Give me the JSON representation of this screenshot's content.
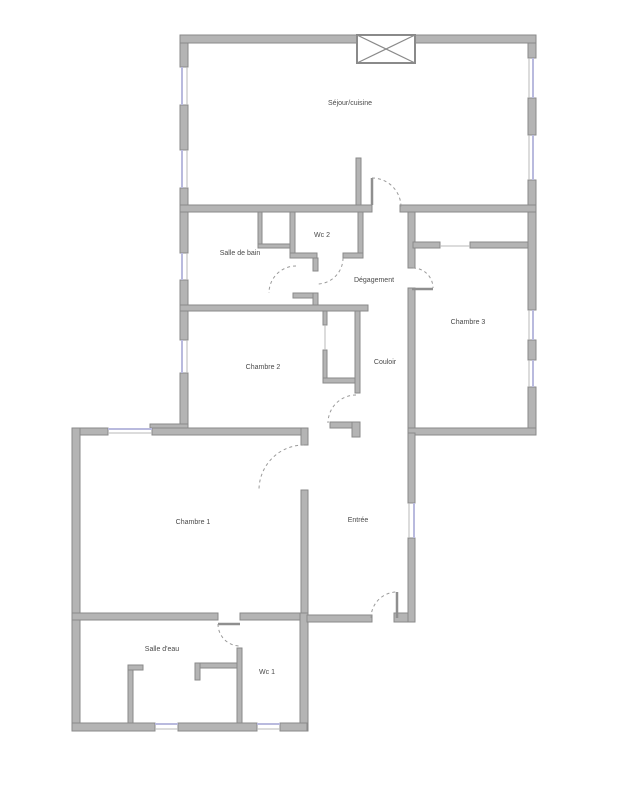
{
  "page": {
    "background": "#ffffff",
    "width": 640,
    "height": 800
  },
  "floorplan": {
    "colors": {
      "wall_fill": "#b4b4b4",
      "wall_stroke": "#8a8a8a",
      "window": "#b9bade",
      "inner_line": "#b9b9b9",
      "thin_wall": "#8f8f8f",
      "door_arc": "#9a9a9a",
      "door_leaf": "#8f8f8f",
      "label": "#4a4a4a"
    },
    "label_font_size": 7,
    "rooms": [
      {
        "id": "sejour-cuisine",
        "label": "Séjour/cuisine",
        "x": 350,
        "y": 105
      },
      {
        "id": "wc-2",
        "label": "Wc 2",
        "x": 322,
        "y": 237
      },
      {
        "id": "salle-de-bain",
        "label": "Salle de bain",
        "x": 240,
        "y": 255
      },
      {
        "id": "degagement",
        "label": "Dégagement",
        "x": 374,
        "y": 282
      },
      {
        "id": "chambre-3",
        "label": "Chambre 3",
        "x": 468,
        "y": 324
      },
      {
        "id": "chambre-2",
        "label": "Chambre 2",
        "x": 263,
        "y": 369
      },
      {
        "id": "couloir",
        "label": "Couloir",
        "x": 385,
        "y": 364
      },
      {
        "id": "chambre-1",
        "label": "Chambre 1",
        "x": 193,
        "y": 524
      },
      {
        "id": "entree",
        "label": "Entrée",
        "x": 358,
        "y": 522
      },
      {
        "id": "salle-d-eau",
        "label": "Salle d'eau",
        "x": 162,
        "y": 651
      },
      {
        "id": "wc-1",
        "label": "Wc 1",
        "x": 267,
        "y": 674
      }
    ],
    "walls": [
      [
        180,
        35,
        356,
        8
      ],
      [
        180,
        43,
        8,
        24
      ],
      [
        180,
        105,
        8,
        45
      ],
      [
        180,
        188,
        8,
        24
      ],
      [
        528,
        43,
        8,
        15
      ],
      [
        528,
        98,
        8,
        37
      ],
      [
        528,
        180,
        8,
        32
      ],
      [
        180,
        205,
        192,
        7
      ],
      [
        400,
        205,
        136,
        7
      ],
      [
        356,
        158,
        5,
        47
      ],
      [
        180,
        212,
        8,
        41
      ],
      [
        180,
        280,
        8,
        60
      ],
      [
        180,
        373,
        8,
        55
      ],
      [
        258,
        212,
        4,
        36
      ],
      [
        258,
        244,
        36,
        4
      ],
      [
        290,
        212,
        5,
        46
      ],
      [
        358,
        212,
        5,
        46
      ],
      [
        290,
        253,
        27,
        5
      ],
      [
        343,
        253,
        20,
        5
      ],
      [
        313,
        258,
        5,
        13
      ],
      [
        293,
        293,
        22,
        5
      ],
      [
        313,
        293,
        5,
        17
      ],
      [
        180,
        305,
        188,
        6
      ],
      [
        323,
        311,
        4,
        14
      ],
      [
        323,
        350,
        4,
        33
      ],
      [
        323,
        378,
        37,
        5
      ],
      [
        355,
        311,
        5,
        82
      ],
      [
        408,
        212,
        7,
        56
      ],
      [
        408,
        288,
        7,
        145
      ],
      [
        413,
        242,
        27,
        6
      ],
      [
        470,
        242,
        66,
        6
      ],
      [
        528,
        212,
        8,
        98
      ],
      [
        528,
        340,
        8,
        20
      ],
      [
        528,
        387,
        8,
        41
      ],
      [
        408,
        428,
        128,
        7
      ],
      [
        72,
        428,
        36,
        7
      ],
      [
        152,
        428,
        155,
        7
      ],
      [
        150,
        424,
        38,
        4
      ],
      [
        330,
        422,
        30,
        6
      ],
      [
        352,
        422,
        8,
        15
      ],
      [
        301,
        428,
        7,
        17
      ],
      [
        301,
        490,
        7,
        130
      ],
      [
        72,
        428,
        8,
        302
      ],
      [
        72,
        613,
        146,
        7
      ],
      [
        240,
        613,
        67,
        7
      ],
      [
        300,
        613,
        8,
        118
      ],
      [
        237,
        648,
        5,
        75
      ],
      [
        128,
        665,
        5,
        58
      ],
      [
        128,
        665,
        15,
        5
      ],
      [
        195,
        663,
        42,
        5
      ],
      [
        195,
        663,
        5,
        17
      ],
      [
        72,
        723,
        83,
        8
      ],
      [
        178,
        723,
        79,
        8
      ],
      [
        280,
        723,
        27,
        8
      ],
      [
        307,
        615,
        65,
        7
      ],
      [
        394,
        613,
        21,
        9
      ],
      [
        408,
        433,
        7,
        70
      ],
      [
        408,
        538,
        7,
        84
      ]
    ],
    "windows": [
      [
        182,
        67,
        182,
        105
      ],
      [
        182,
        150,
        182,
        188
      ],
      [
        533,
        58,
        533,
        98
      ],
      [
        533,
        135,
        533,
        180
      ],
      [
        182,
        253,
        182,
        280
      ],
      [
        182,
        340,
        182,
        373
      ],
      [
        533,
        310,
        533,
        340
      ],
      [
        533,
        360,
        533,
        387
      ],
      [
        108,
        429,
        152,
        429
      ],
      [
        414,
        503,
        414,
        538
      ],
      [
        155,
        724,
        178,
        724
      ],
      [
        257,
        724,
        280,
        724
      ]
    ],
    "thin_lines": [
      [
        325,
        325,
        325,
        350
      ],
      [
        440,
        246,
        470,
        246
      ],
      [
        187,
        67,
        187,
        105
      ],
      [
        187,
        150,
        187,
        188
      ],
      [
        529,
        58,
        529,
        98
      ],
      [
        529,
        135,
        529,
        180
      ],
      [
        187,
        253,
        187,
        280
      ],
      [
        187,
        340,
        187,
        373
      ],
      [
        529,
        310,
        529,
        340
      ],
      [
        529,
        360,
        529,
        387
      ],
      [
        108,
        433,
        152,
        433
      ],
      [
        409,
        503,
        409,
        538
      ],
      [
        155,
        729,
        178,
        729
      ],
      [
        257,
        729,
        280,
        729
      ]
    ],
    "doors": [
      {
        "id": "door-sejour",
        "leaf": [
          372,
          205,
          372,
          178
        ],
        "arc": [
          372,
          178,
          29,
          1,
          401,
          207
        ]
      },
      {
        "id": "door-wc2",
        "leaf": null,
        "arc": [
          343,
          258,
          26,
          1,
          317,
          284
        ]
      },
      {
        "id": "door-salle-de-bain",
        "leaf": null,
        "arc": [
          296,
          266,
          27,
          0,
          269,
          293
        ]
      },
      {
        "id": "door-chambre-3",
        "leaf": [
          412,
          289,
          433,
          289
        ],
        "arc": [
          413,
          268,
          20,
          1,
          433,
          288
        ]
      },
      {
        "id": "door-chambre-2",
        "leaf": null,
        "arc": [
          356,
          395,
          28,
          0,
          328,
          423
        ]
      },
      {
        "id": "door-chambre-1",
        "leaf": null,
        "arc": [
          304,
          445,
          45,
          0,
          259,
          490
        ]
      },
      {
        "id": "door-salle-d-eau",
        "leaf": [
          218,
          624,
          240,
          624
        ],
        "arc": [
          218,
          624,
          22,
          0,
          240,
          646
        ]
      },
      {
        "id": "door-entree",
        "leaf": [
          397,
          592,
          397,
          618
        ],
        "arc": [
          371,
          618,
          26,
          1,
          397,
          592
        ]
      }
    ],
    "shaft": {
      "x": 357,
      "y": 35,
      "w": 58,
      "h": 28
    }
  }
}
